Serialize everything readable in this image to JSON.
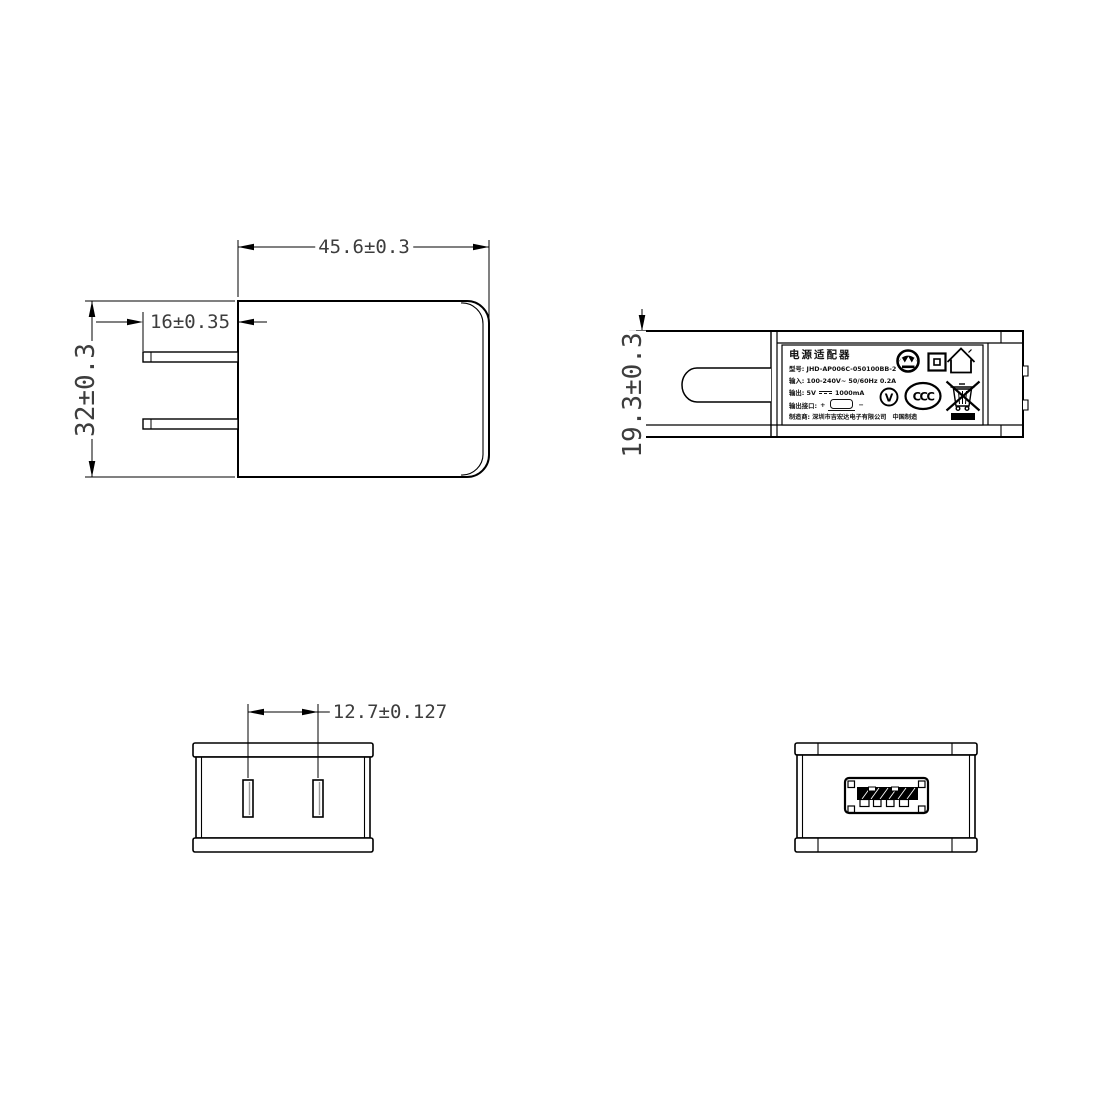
{
  "dimensions": {
    "front_width": "45.6±0.3",
    "prong_length": "16±0.35",
    "front_height": "32±0.3",
    "side_height": "19.3±0.3",
    "prong_pitch": "12.7±0.127"
  },
  "label": {
    "title": "电源适配器",
    "model": "型号: JHD-AP006C-050100BB-2",
    "input": "输入: 100-240V~  50/60Hz  0.2A",
    "output_prefix": "输出: 5V",
    "output_current": "1000mA",
    "port_label": "输出接口:",
    "plus": "+",
    "minus": "−",
    "manufacturer": "制造商: 深圳市吉宏达电子有限公司",
    "made_in": "中国制造",
    "ccc": "CCC",
    "efficiency": "V"
  },
  "icons": [
    "certification-badge-icon",
    "double-insulation-icon",
    "indoor-use-only-icon",
    "efficiency-v-icon",
    "ccc-mark-icon",
    "weee-bin-icon",
    "dc-output-icon",
    "usb-plug-icon",
    "black-bar-icon"
  ],
  "colors": {
    "line": "#000000",
    "dim_text": "#3d3d3d",
    "background": "#ffffff"
  }
}
